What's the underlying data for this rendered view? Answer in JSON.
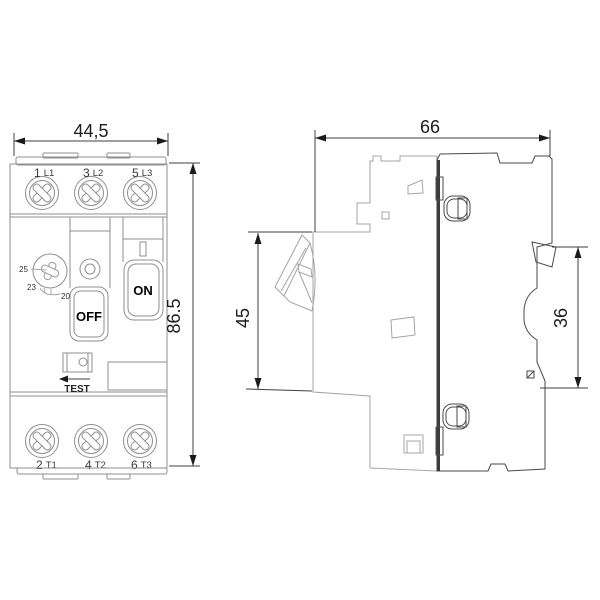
{
  "drawing": {
    "type": "dimensional technical drawing, motor protection circuit breaker",
    "front_view": {
      "dim_width": "44,5",
      "dim_height": "86.5",
      "terminals_top": [
        {
          "num": "1",
          "id": "L1"
        },
        {
          "num": "3",
          "id": "L2"
        },
        {
          "num": "5",
          "id": "L3"
        }
      ],
      "terminals_bottom": [
        {
          "num": "2",
          "id": "T1"
        },
        {
          "num": "4",
          "id": "T2"
        },
        {
          "num": "6",
          "id": "T3"
        }
      ],
      "dial_scale": {
        "v25": "25",
        "v23": "23",
        "v20": "20"
      },
      "buttons": {
        "off": "OFF",
        "on": "ON",
        "test": "TEST"
      }
    },
    "side_view": {
      "dim_width": "66",
      "dim_front_depth": "45",
      "dim_rail_recess": "36"
    },
    "colors": {
      "background": "#ffffff",
      "body_fill": "#d9d9d9",
      "light_outline": "#8f8f8f",
      "dark_outline": "#4a4a4a",
      "text": "#1c1c1c"
    }
  }
}
